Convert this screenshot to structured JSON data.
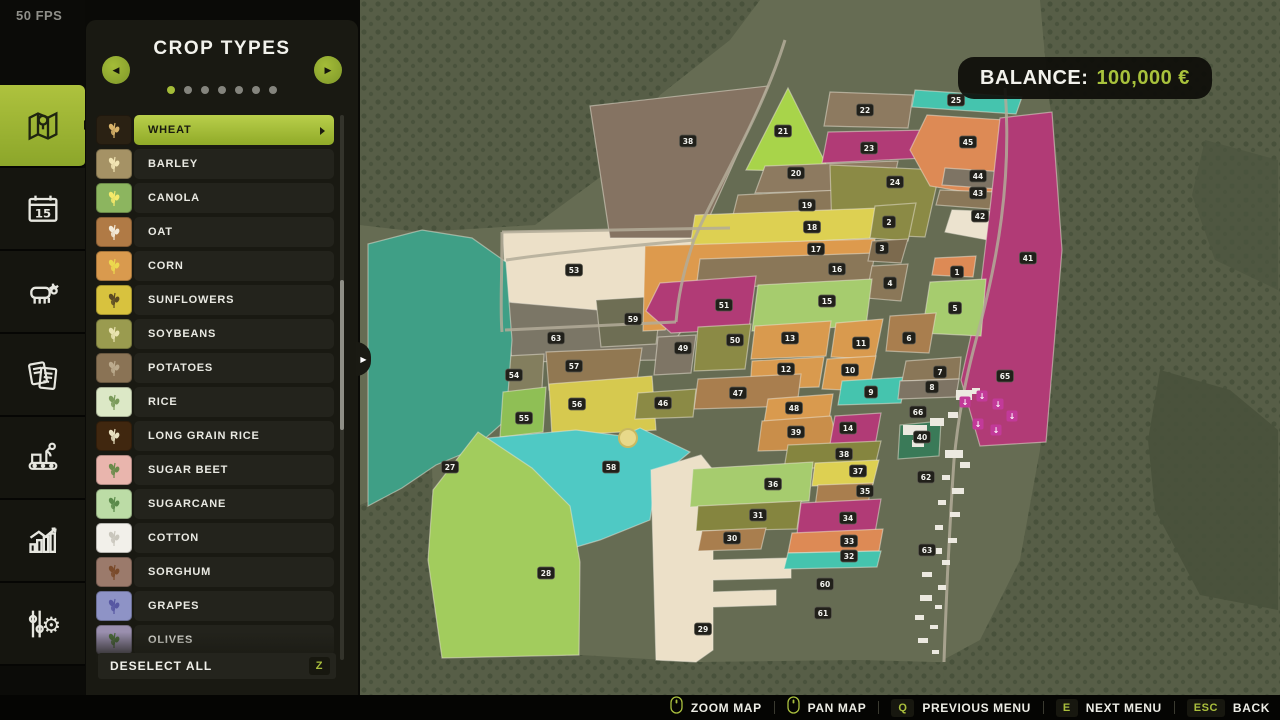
{
  "fps": "50 FPS",
  "sidebar": {
    "tabs": [
      {
        "id": "map",
        "active": true
      },
      {
        "id": "calendar",
        "active": false
      },
      {
        "id": "animals",
        "active": false
      },
      {
        "id": "contracts",
        "active": false
      },
      {
        "id": "production",
        "active": false
      },
      {
        "id": "statistics",
        "active": false
      },
      {
        "id": "settings",
        "active": false
      }
    ]
  },
  "panel": {
    "title": "CROP TYPES",
    "page_dots": 7,
    "active_dot": 0,
    "crops": [
      {
        "label": "WHEAT",
        "tile": "#2a2113",
        "grain": "#d8b36a",
        "selected": true
      },
      {
        "label": "BARLEY",
        "tile": "#a59265",
        "grain": "#f2e5b4",
        "selected": false
      },
      {
        "label": "CANOLA",
        "tile": "#8cb55f",
        "grain": "#f5e96a",
        "selected": false
      },
      {
        "label": "OAT",
        "tile": "#b07a45",
        "grain": "#f3ead8",
        "selected": false
      },
      {
        "label": "CORN",
        "tile": "#d99a4e",
        "grain": "#ecd84e",
        "selected": false
      },
      {
        "label": "SUNFLOWERS",
        "tile": "#d8c23e",
        "grain": "#5c4a22",
        "selected": false
      },
      {
        "label": "SOYBEANS",
        "tile": "#9a9b4f",
        "grain": "#e9e3b0",
        "selected": false
      },
      {
        "label": "POTATOES",
        "tile": "#8a7355",
        "grain": "#bcab8e",
        "selected": false
      },
      {
        "label": "RICE",
        "tile": "#dce8c6",
        "grain": "#7a9a5a",
        "selected": false
      },
      {
        "label": "LONG GRAIN RICE",
        "tile": "#40270f",
        "grain": "#e8e0c0",
        "selected": false
      },
      {
        "label": "SUGAR BEET",
        "tile": "#e9b5ad",
        "grain": "#6a8a4a",
        "selected": false
      },
      {
        "label": "SUGARCANE",
        "tile": "#bcdca6",
        "grain": "#5a8a4a",
        "selected": false
      },
      {
        "label": "COTTON",
        "tile": "#f2f0ea",
        "grain": "#c9c6bc",
        "selected": false
      },
      {
        "label": "SORGHUM",
        "tile": "#9b7a6b",
        "grain": "#7a4a2a",
        "selected": false
      },
      {
        "label": "GRAPES",
        "tile": "#8e93c6",
        "grain": "#5757a2",
        "selected": false
      },
      {
        "label": "OLIVES",
        "tile": "#9a8fae",
        "grain": "#4a6a3a",
        "selected": false
      }
    ],
    "deselect_label": "DESELECT ALL",
    "deselect_key": "Z"
  },
  "balance": {
    "label": "BALANCE:",
    "amount": "100,000 €"
  },
  "hotbar": [
    {
      "icon": "mouse",
      "key": "",
      "label": "ZOOM MAP"
    },
    {
      "icon": "mouse",
      "key": "",
      "label": "PAN MAP"
    },
    {
      "icon": "",
      "key": "Q",
      "label": "PREVIOUS MENU"
    },
    {
      "icon": "",
      "key": "E",
      "label": "NEXT MENU"
    },
    {
      "icon": "",
      "key": "ESC",
      "label": "BACK"
    }
  ],
  "map": {
    "bg": "#666c53",
    "forest_base": "#575e47",
    "tree_dot": "#46503a",
    "badge_bg": "#21201a",
    "badge_text": "#f2f2ee",
    "road_color": "#b3ab99",
    "building_color": "#ece9e0",
    "marker_color": "#c23a99",
    "forests": [
      "0,0 400,0 370,40 300,95 250,170 175,225 60,232 0,225",
      "0,505 42,488 72,465 74,560 80,660 0,660",
      "0,630 80,640 220,655 340,662 500,660 680,665 680,695 0,695",
      "680,0 920,0 920,695 585,695 583,660 620,640 660,560 680,450 695,300 700,180 688,90"
    ],
    "dark_blobs": [
      {
        "c": "#4a523c",
        "p": "800,370 870,390 918,430 918,610 840,595 795,510 788,440"
      },
      {
        "c": "#4f5741",
        "p": "845,140 918,160 918,290 855,260 832,195"
      }
    ],
    "fields": [
      {
        "n": "53",
        "c": "#ece0c8",
        "p": "143,232 370,227 358,298 330,316 200,322 146,300",
        "b": [
          214,
          270
        ]
      },
      {
        "n": "63",
        "c": "#7b7666",
        "p": "146,302 330,318 302,360 152,362",
        "b": [
          196,
          338
        ]
      },
      {
        "n": "57",
        "c": "#917852",
        "p": "186,352 282,348 276,388 189,390",
        "b": [
          214,
          366
        ]
      },
      {
        "n": "54",
        "c": "#837e5e",
        "p": "108,358 184,354 181,405 112,412",
        "b": [
          154,
          375
        ]
      },
      {
        "n": "59",
        "c": "#6e6e54",
        "p": "236,300 302,296 296,344 241,347",
        "b": [
          273,
          319
        ]
      },
      {
        "n": "27",
        "c": "#3f9f86",
        "p": "8,244 62,230 112,238 146,262 152,340 146,420 112,450 76,465 42,488 8,506",
        "b": [
          90,
          467
        ]
      },
      {
        "n": "55",
        "c": "#8fbf55",
        "p": "143,392 186,387 183,432 140,437",
        "b": [
          164,
          418
        ]
      },
      {
        "n": "56",
        "c": "#d6c94f",
        "p": "189,384 292,376 296,430 192,436",
        "b": [
          217,
          404
        ]
      },
      {
        "n": "58",
        "c": "#4fc9c4",
        "p": "128,438 216,430 262,436 280,428 330,452 296,480 290,520 240,540 186,556 146,510 126,470",
        "b": [
          251,
          467
        ]
      },
      {
        "n": "28",
        "c": "#a2cc5d",
        "p": "118,432 172,468 210,506 220,562 219,655 82,658 68,560 73,490",
        "b": [
          186,
          573
        ]
      },
      {
        "n": "29",
        "c": "#ece0c8",
        "p": "291,470 341,455 353,470 353,560 431,558 431,578 353,580 353,592 416,590 416,605 353,607 353,650 336,662 296,660",
        "b": [
          343,
          629
        ]
      },
      {
        "n": "38",
        "c": "#857362",
        "p": "230,106 408,86 340,238 250,238",
        "b": [
          328,
          141
        ]
      },
      {
        "n": "21",
        "c": "#a8d44a",
        "p": "386,170 428,88 470,172",
        "b": [
          423,
          131
        ]
      },
      {
        "n": "22",
        "c": "#8d7a60",
        "p": "470,92 553,95 548,128 464,126",
        "b": [
          505,
          110
        ]
      },
      {
        "n": "23",
        "c": "#b13b76",
        "p": "468,132 570,130 565,158 462,163",
        "b": [
          509,
          148
        ]
      },
      {
        "n": "20",
        "c": "#8d7a60",
        "p": "405,166 538,161 532,189 395,193",
        "b": [
          436,
          173
        ]
      },
      {
        "n": "19",
        "c": "#8a7758",
        "p": "378,195 520,188 515,213 372,219",
        "b": [
          447,
          205
        ]
      },
      {
        "n": "24",
        "c": "#8b8a45",
        "p": "470,165 580,170 565,237 472,233",
        "b": [
          535,
          182
        ]
      },
      {
        "n": "25",
        "c": "#45c4ae",
        "p": "555,90 662,97 656,114 552,107",
        "b": [
          596,
          100
        ]
      },
      {
        "n": "45",
        "c": "#dd8a55",
        "p": "567,115 660,121 630,196 570,186 550,150",
        "b": [
          608,
          142
        ]
      },
      {
        "n": "44",
        "c": "#7e7464",
        "p": "585,168 646,172 638,189 582,185",
        "b": [
          618,
          176
        ]
      },
      {
        "n": "43",
        "c": "#8a7758",
        "p": "580,190 638,192 630,209 576,205",
        "b": [
          618,
          193
        ]
      },
      {
        "n": "42",
        "c": "#ece3cf",
        "p": "592,210 640,212 628,240 585,232",
        "b": [
          620,
          216
        ]
      },
      {
        "n": "41",
        "c": "#b13b76",
        "p": "640,118 692,112 702,250 686,442 620,446 601,380 619,300 631,200",
        "b": [
          668,
          258
        ]
      },
      {
        "n": "18",
        "c": "#ddd052",
        "p": "335,215 520,208 515,238 330,247",
        "b": [
          452,
          227
        ]
      },
      {
        "n": "17",
        "c": "#dd9a4d",
        "p": "285,246 515,239 510,263 345,271 305,330 283,331",
        "b": [
          456,
          249
        ]
      },
      {
        "n": "16",
        "c": "#8a7758",
        "p": "340,259 515,253 510,281 336,289",
        "b": [
          477,
          269
        ]
      },
      {
        "n": "2",
        "c": "#8b8a45",
        "p": "515,206 556,203 548,241 510,238",
        "b": [
          529,
          222
        ]
      },
      {
        "n": "3",
        "c": "#7c6a4e",
        "p": "512,241 548,239 541,263 508,261",
        "b": [
          522,
          248
        ]
      },
      {
        "n": "4",
        "c": "#8a7758",
        "p": "512,266 548,264 541,301 506,298",
        "b": [
          530,
          283
        ]
      },
      {
        "n": "1",
        "c": "#dd8a55",
        "p": "575,258 616,256 613,277 572,275",
        "b": [
          597,
          272
        ]
      },
      {
        "n": "5",
        "c": "#a6cc6e",
        "p": "570,282 626,279 621,336 562,333",
        "b": [
          595,
          308
        ]
      },
      {
        "n": "15",
        "c": "#a6cc6e",
        "p": "398,285 512,279 506,326 392,331",
        "b": [
          467,
          301
        ]
      },
      {
        "n": "51",
        "c": "#b13b76",
        "p": "300,283 396,276 389,329 311,333 286,311",
        "b": [
          364,
          305
        ]
      },
      {
        "n": "50",
        "c": "#8b8a45",
        "p": "338,327 391,324 385,369 334,371",
        "b": [
          375,
          340
        ]
      },
      {
        "n": "49",
        "c": "#7e7565",
        "p": "298,337 336,335 331,373 294,375",
        "b": [
          323,
          348
        ]
      },
      {
        "n": "13",
        "c": "#d99a4e",
        "p": "395,326 471,321 466,356 391,359",
        "b": [
          430,
          338
        ]
      },
      {
        "n": "11",
        "c": "#d99a4e",
        "p": "476,323 523,319 515,359 471,357",
        "b": [
          501,
          343
        ]
      },
      {
        "n": "6",
        "c": "#a97e4e",
        "p": "530,316 576,313 569,353 526,351",
        "b": [
          549,
          338
        ]
      },
      {
        "n": "12",
        "c": "#d99a4e",
        "p": "392,361 464,357 459,387 390,389",
        "b": [
          426,
          369
        ]
      },
      {
        "n": "10",
        "c": "#d99a4e",
        "p": "467,359 516,356 509,391 462,389",
        "b": [
          490,
          370
        ]
      },
      {
        "n": "9",
        "c": "#45c4ae",
        "p": "482,381 546,377 541,403 478,405",
        "b": [
          511,
          392
        ]
      },
      {
        "n": "7",
        "c": "#8a7758",
        "p": "546,361 601,357 599,379 542,381",
        "b": [
          580,
          372
        ]
      },
      {
        "n": "8",
        "c": "#7e7464",
        "p": "540,381 599,379 596,397 538,399",
        "b": [
          572,
          387
        ]
      },
      {
        "n": "47",
        "c": "#a97e4e",
        "p": "338,379 441,374 437,406 334,409",
        "b": [
          378,
          393
        ]
      },
      {
        "n": "46",
        "c": "#8b8a45",
        "p": "278,393 336,389 333,417 275,419",
        "b": [
          303,
          403
        ]
      },
      {
        "n": "48",
        "c": "#d99a4e",
        "p": "408,399 473,394 469,421 404,423",
        "b": [
          434,
          408
        ]
      },
      {
        "n": "39",
        "c": "#c98e4a",
        "p": "402,421 471,416 479,449 398,451",
        "b": [
          436,
          432
        ]
      },
      {
        "n": "14",
        "c": "#b13b76",
        "p": "475,416 521,413 515,446 470,444",
        "b": [
          488,
          428
        ]
      },
      {
        "n": "40",
        "c": "#3a7a58",
        "p": "540,425 581,421 579,456 538,459",
        "b": [
          562,
          437
        ]
      },
      {
        "n": "38",
        "c": "#85853f",
        "p": "428,445 521,441 515,466 424,469",
        "b": [
          484,
          454
        ]
      },
      {
        "n": "37",
        "c": "#ddd052",
        "p": "455,463 519,460 513,484 452,486",
        "b": [
          498,
          471
        ]
      },
      {
        "n": "35",
        "c": "#a97e4e",
        "p": "458,485 513,483 507,506 455,507",
        "b": [
          505,
          491
        ]
      },
      {
        "n": "36",
        "c": "#a6cc6e",
        "p": "333,469 453,462 449,501 330,507",
        "b": [
          413,
          484
        ]
      },
      {
        "n": "31",
        "c": "#85853f",
        "p": "338,506 441,501 437,529 336,531",
        "b": [
          398,
          515
        ]
      },
      {
        "n": "34",
        "c": "#b13b76",
        "p": "441,503 521,499 515,533 437,534",
        "b": [
          488,
          518
        ]
      },
      {
        "n": "30",
        "c": "#a97e4e",
        "p": "342,531 406,528 401,549 338,551",
        "b": [
          372,
          538
        ]
      },
      {
        "n": "33",
        "c": "#dd8a55",
        "p": "432,533 523,529 519,551 428,553",
        "b": [
          489,
          541
        ]
      },
      {
        "n": "32",
        "c": "#45c4ae",
        "p": "428,553 521,551 517,567 424,569",
        "b": [
          489,
          556
        ]
      },
      {
        "n": "60",
        "c": "",
        "p": "",
        "b": [
          465,
          584
        ]
      },
      {
        "n": "61",
        "c": "",
        "p": "",
        "b": [
          463,
          613
        ]
      },
      {
        "n": "65",
        "c": "",
        "p": "",
        "b": [
          645,
          376
        ]
      },
      {
        "n": "66",
        "c": "",
        "p": "",
        "b": [
          558,
          412
        ]
      },
      {
        "n": "62",
        "c": "",
        "p": "",
        "b": [
          566,
          477
        ]
      },
      {
        "n": "63",
        "c": "",
        "p": "",
        "b": [
          567,
          550
        ]
      }
    ],
    "roads": [
      "M425,40 C400,120 352,195 334,240 C322,275 318,300 316,322",
      "M645,88 C652,180 638,260 616,340 C604,385 598,420 594,460 C590,520 586,600 584,662",
      "M316,322 L145,330",
      "M142,232 L370,228",
      "M142,232 C142,280 140,310 142,332",
      "M334,240 C270,246 200,252 146,260"
    ],
    "buildings": [
      [
        543,
        425,
        24,
        10
      ],
      [
        570,
        418,
        14,
        8
      ],
      [
        596,
        390,
        16,
        10
      ],
      [
        612,
        388,
        8,
        6
      ],
      [
        588,
        412,
        10,
        6
      ],
      [
        552,
        440,
        12,
        7
      ],
      [
        585,
        450,
        18,
        8
      ],
      [
        600,
        462,
        10,
        6
      ],
      [
        582,
        475,
        8,
        5
      ],
      [
        592,
        488,
        12,
        6
      ],
      [
        578,
        500,
        8,
        5
      ],
      [
        590,
        512,
        10,
        5
      ],
      [
        575,
        525,
        8,
        5
      ],
      [
        588,
        538,
        9,
        5
      ],
      [
        570,
        548,
        12,
        6
      ],
      [
        582,
        560,
        8,
        5
      ],
      [
        562,
        572,
        10,
        5
      ],
      [
        578,
        585,
        8,
        5
      ],
      [
        560,
        595,
        12,
        6
      ],
      [
        575,
        605,
        7,
        4
      ],
      [
        555,
        615,
        9,
        5
      ],
      [
        570,
        625,
        8,
        4
      ],
      [
        558,
        638,
        10,
        5
      ],
      [
        572,
        650,
        7,
        4
      ]
    ],
    "markers": [
      [
        605,
        402
      ],
      [
        622,
        396
      ],
      [
        638,
        404
      ],
      [
        652,
        416
      ],
      [
        618,
        424
      ],
      [
        636,
        430
      ]
    ],
    "poi": [
      268,
      438
    ]
  }
}
